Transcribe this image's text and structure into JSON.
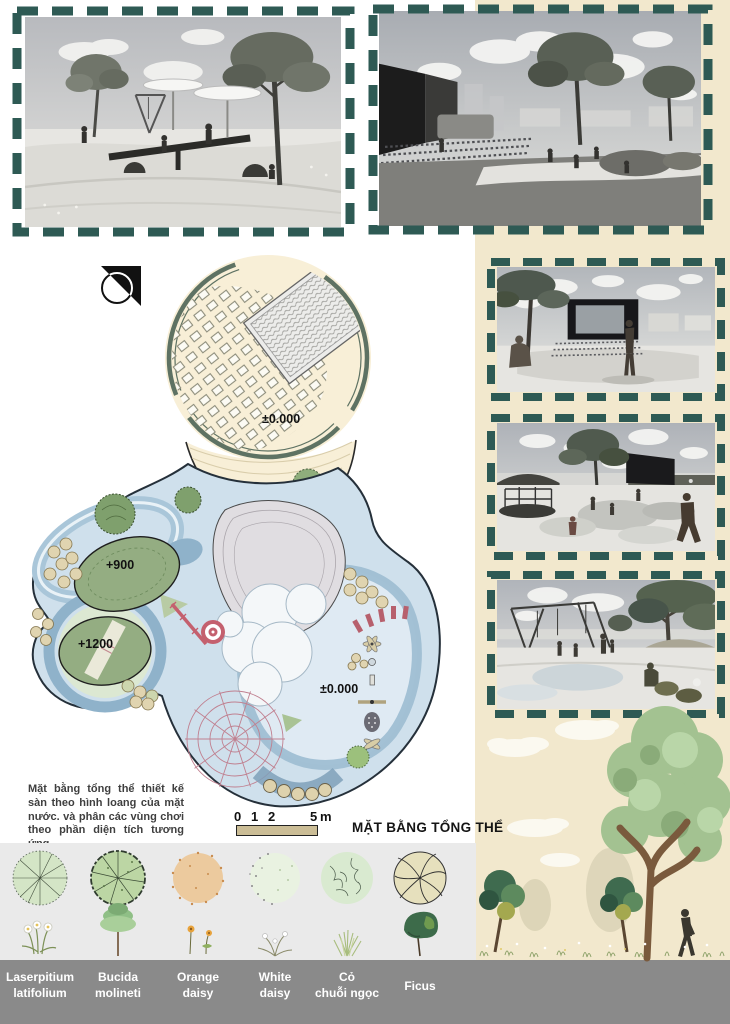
{
  "plan": {
    "title": "MẶT BẰNG TỔNG THỂ",
    "note": "Mặt bằng tổng thể thiết kế sàn theo hình loang của mặt nước. và phân các vùng chơi theo phần diện tích tương ứng.",
    "levels": {
      "event_plaza": "±0.000",
      "mound_900": "+900",
      "mound_1200": "+1200",
      "play_area": "±0.000"
    },
    "scale_bar": {
      "t0": "0",
      "t1": "1",
      "t2": "2",
      "t3": "5",
      "unit": "m"
    }
  },
  "legend": {
    "items": [
      {
        "name": "Laserpitium latifolium",
        "line1": "Laserpitium",
        "line2": "latifolium"
      },
      {
        "name": "Bucida molineti",
        "line1": "Bucida",
        "line2": "molineti"
      },
      {
        "name": "Orange daisy",
        "line1": "Orange",
        "line2": "daisy"
      },
      {
        "name": "White daisy",
        "line1": "White",
        "line2": "daisy"
      },
      {
        "name": "Cỏ chuỗi ngọc",
        "line1": "Cỏ",
        "line2": "chuỗi ngọc"
      },
      {
        "name": "Ficus",
        "line1": "Ficus",
        "line2": ""
      }
    ]
  },
  "colors": {
    "frame_dash": "#2e5a54",
    "cream": "#f2e8cd",
    "plan_cream": "#f8efd7",
    "water": "#cfe0ec",
    "water_dark": "#8fb2ca",
    "mound_green": "#94ad82",
    "pond_gray": "#e0dde1",
    "accent_red": "#c4606e",
    "legend_bg": "#eaeaea",
    "legend_band": "#8a8a8a"
  }
}
